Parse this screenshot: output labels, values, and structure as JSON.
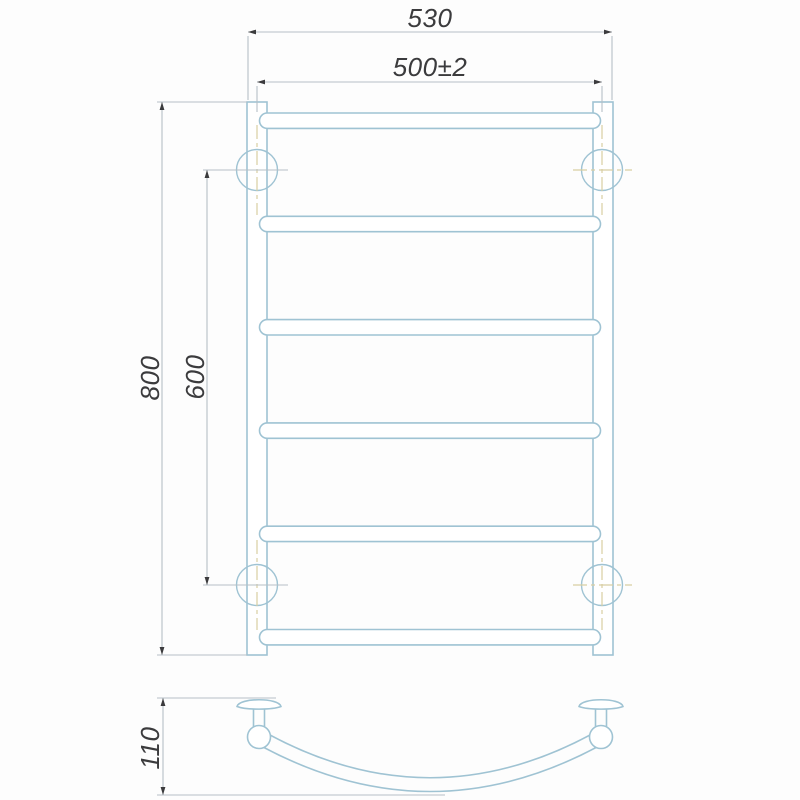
{
  "dimensions": {
    "overall_width": "530",
    "bar_length": "500±2",
    "overall_height": "800",
    "bracket_spacing": "600",
    "depth": "110"
  },
  "front_view": {
    "bar_count": 6,
    "bracket_count": 4
  },
  "side_view": {
    "bracket_count": 2
  },
  "colors": {
    "outline": "#9fc3d3",
    "centerline": "#d8cea2",
    "dimension_line": "#b6bfc6",
    "text": "#3b3b3d",
    "background": "#fdfdfd"
  }
}
